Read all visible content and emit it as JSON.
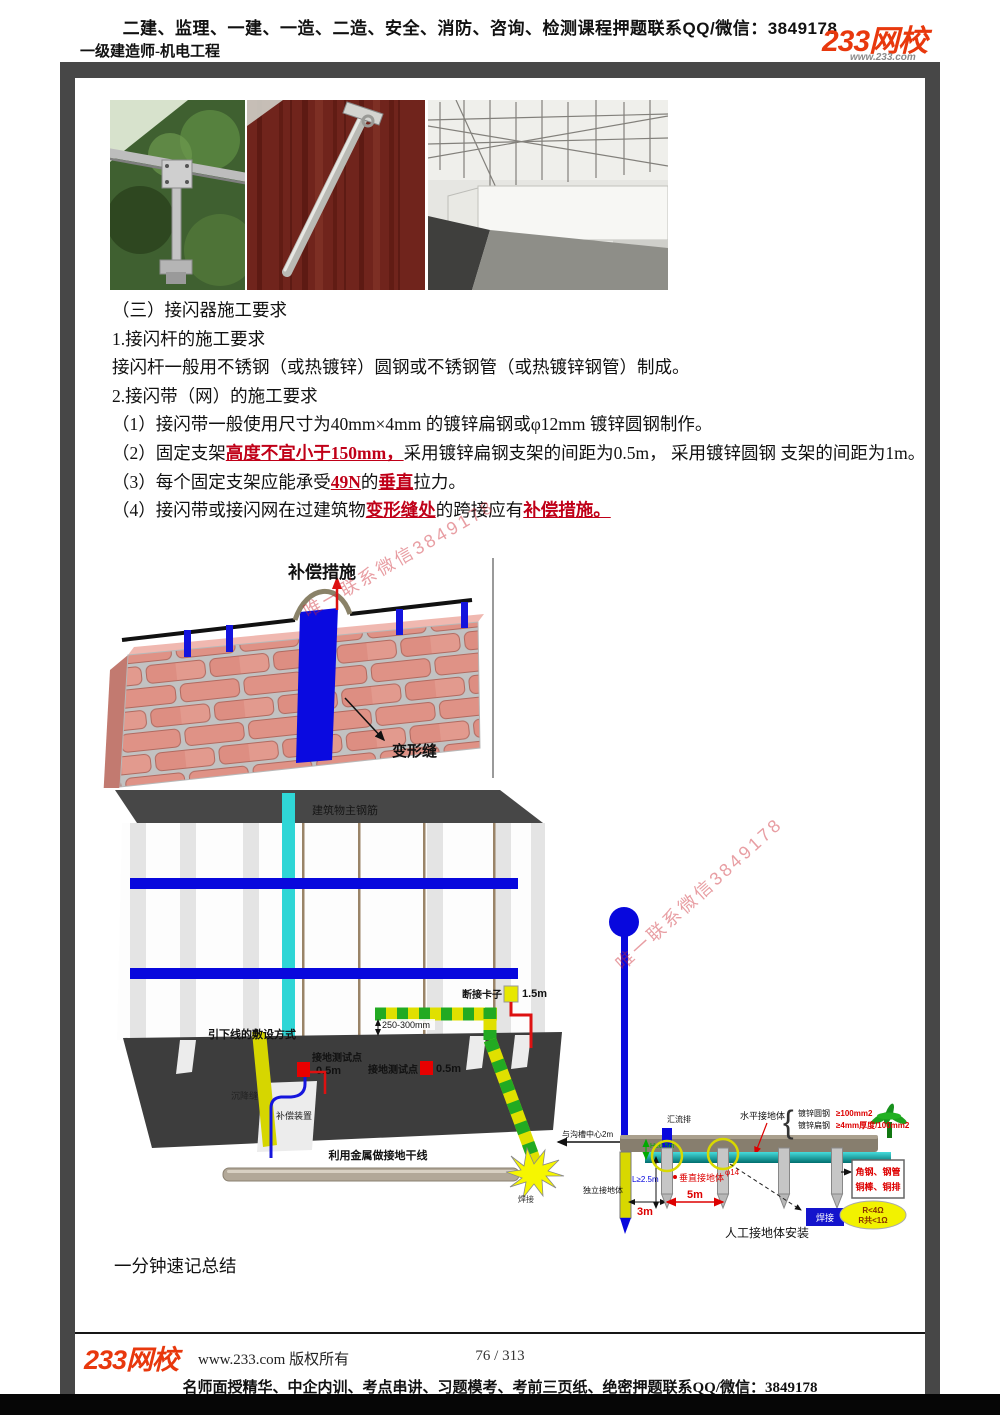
{
  "header": {
    "promo": "二建、监理、一建、一造、二造、安全、消防、咨询、检测课程押题联系QQ/微信：3849178",
    "course": "一级建造师-机电工程",
    "logo": "233网校",
    "logo_sub": "www.233.com"
  },
  "content": {
    "s1": "（三）接闪器施工要求",
    "s2": "1.接闪杆的施工要求",
    "s3": "接闪杆一般用不锈钢（或热镀锌）圆钢或不锈钢管（或热镀锌钢管）制成。",
    "s4": "2.接闪带（网）的施工要求",
    "s5": "（1）接闪带一般使用尺寸为40mm×4mm 的镀锌扁钢或φ12mm 镀锌圆钢制作。",
    "s6a": "（2）固定支架",
    "s6b": "高度不宜小于150mm，",
    "s6c": "采用镀锌扁钢支架的间距为0.5m， 采用镀锌圆钢 支架的间距为1m。",
    "s7a": "（3）每个固定支架应能承受",
    "s7b": "49N",
    "s7c": "的",
    "s7d": "垂直",
    "s7e": "拉力。",
    "s8a": "（4）接闪带或接闪网在过建筑物",
    "s8b": "变形缝处",
    "s8c": "的跨接应有",
    "s8d": "补偿措施。"
  },
  "figure1": {
    "comp": "补偿措施",
    "joint": "变形缝"
  },
  "figure2": {
    "rebar": "建筑物主钢筋",
    "downlead": "引下线的敷设方式",
    "test_point": "接地测试点",
    "test_value": "0.5m",
    "clamp": "断接卡子",
    "clamp_value": "1.5m",
    "dim_250": "250-300mm",
    "settlement": "沉降缝",
    "comp_device": "补偿装置",
    "trunk": "利用金属做接地干线",
    "weld": "焊接",
    "dim_2m": "与沟槽中心2m",
    "busbar": "汇流排",
    "horizontal": "水平接地体",
    "spec_round": "镀锌圆钢",
    "spec_round_val": "≥100mm2",
    "spec_flat": "镀锌扁钢",
    "spec_flat_val": "≥4mm厚度/100mm2",
    "dim_h": "H≥0.5m",
    "dim_l": "L≥2.5m",
    "dim_3m": "3m",
    "dim_5m": "5m",
    "independent": "独立接地体",
    "vertical": "垂直接地体",
    "dim_phi": "φ14",
    "install": "人工接地体安装",
    "materials1": "角钢、钢管",
    "materials2": "铜棒、铜排",
    "res1": "R<4Ω",
    "res2": "R共<1Ω"
  },
  "summary": {
    "title": "一分钟速记总结"
  },
  "watermark": {
    "text": "唯一联系微信3849178"
  },
  "footer": {
    "logo": "233网校",
    "copyright": "www.233.com 版权所有",
    "page": "76 / 313",
    "promo": "名师面授精华、中企内训、考点串讲、习题模考、考前三页纸、绝密押题联系QQ/微信：3849178"
  }
}
